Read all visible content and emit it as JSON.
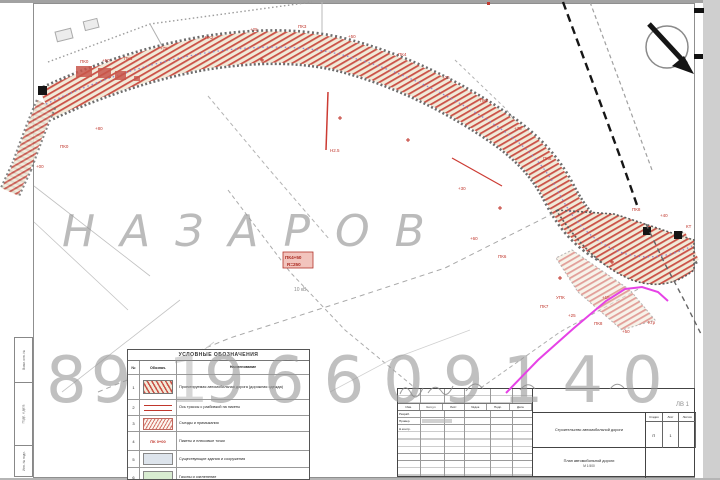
{
  "watermark": {
    "name": "НАЗАРОВ",
    "phone_part1": "89",
    "phone_part2": "1",
    "phone_part3": "96609140"
  },
  "map": {
    "power_note": "10 кВ",
    "station_box": {
      "line1": "ПК4+50",
      "line2": "R=250"
    },
    "pickets": [
      {
        "x": 80,
        "y": 63,
        "t": "ПК0"
      },
      {
        "x": 102,
        "y": 62,
        "t": "+50"
      },
      {
        "x": 124,
        "y": 60,
        "t": "ПК1"
      },
      {
        "x": 160,
        "y": 50,
        "t": "+75"
      },
      {
        "x": 205,
        "y": 39,
        "t": "ПК2"
      },
      {
        "x": 250,
        "y": 31,
        "t": "+25"
      },
      {
        "x": 298,
        "y": 28,
        "t": "ПК3"
      },
      {
        "x": 348,
        "y": 38,
        "t": "+50"
      },
      {
        "x": 398,
        "y": 56,
        "t": "ПК4"
      },
      {
        "x": 442,
        "y": 79,
        "t": "+25"
      },
      {
        "x": 480,
        "y": 102,
        "t": "ПК5"
      },
      {
        "x": 514,
        "y": 130,
        "t": "+75"
      },
      {
        "x": 543,
        "y": 160,
        "t": "ПК6"
      },
      {
        "x": 95,
        "y": 130,
        "t": "+80"
      },
      {
        "x": 60,
        "y": 148,
        "t": "ПК0"
      },
      {
        "x": 36,
        "y": 168,
        "t": "+00"
      },
      {
        "x": 330,
        "y": 152,
        "t": "Н2.5"
      },
      {
        "x": 458,
        "y": 190,
        "t": "+30"
      },
      {
        "x": 470,
        "y": 240,
        "t": "+60"
      },
      {
        "x": 498,
        "y": 258,
        "t": "ПК6"
      },
      {
        "x": 540,
        "y": 308,
        "t": "ПК7"
      },
      {
        "x": 568,
        "y": 317,
        "t": "+25"
      },
      {
        "x": 594,
        "y": 325,
        "t": "ПК8"
      },
      {
        "x": 622,
        "y": 333,
        "t": "+50"
      },
      {
        "x": 648,
        "y": 324,
        "t": "Ктр"
      },
      {
        "x": 602,
        "y": 299,
        "t": "+15"
      },
      {
        "x": 556,
        "y": 299,
        "t": "УПК"
      },
      {
        "x": 632,
        "y": 211,
        "t": "ПК8"
      },
      {
        "x": 660,
        "y": 217,
        "t": "+40"
      },
      {
        "x": 686,
        "y": 228,
        "t": "КТ"
      }
    ],
    "crosses": [
      {
        "x": 340,
        "y": 118
      },
      {
        "x": 408,
        "y": 140
      },
      {
        "x": 262,
        "y": 60
      },
      {
        "x": 500,
        "y": 208
      },
      {
        "x": 560,
        "y": 278
      },
      {
        "x": 612,
        "y": 262
      }
    ]
  },
  "legend": {
    "title": "УСЛОВНЫЕ ОБОЗНАЧЕНИЯ",
    "col_num": "№",
    "col_sym": "Обознач.",
    "col_name": "Наименование",
    "rows": [
      {
        "num": "1",
        "sym": "",
        "name": "Проектируемая автомобильная дорога (дорожная одежда)"
      },
      {
        "num": "2",
        "sym": "",
        "name": "Ось трассы с разбивкой на пикеты"
      },
      {
        "num": "3",
        "sym": "",
        "name": "Съезды и примыкания"
      },
      {
        "num": "4",
        "sym": "ПК 0+00",
        "name": "Пикеты и плюсовые точки"
      },
      {
        "num": "5",
        "sym": "",
        "name": "Существующие здания и сооружения"
      },
      {
        "num": "6",
        "sym": "",
        "name": "Газоны и озеленение"
      }
    ]
  },
  "titleblock": {
    "header_cells": [
      "Изм.",
      "Кол.уч",
      "Лист",
      "№док.",
      "Подп.",
      "Дата"
    ],
    "row_labels": [
      "Разраб.",
      "Провер.",
      "Н.контр."
    ],
    "doc_name": "Строительство автомобильной дороги",
    "drawing_name": "План автомобильной дороги",
    "scale": "М 1:500",
    "stage_label": "Стадия",
    "sheet_label": "Лист",
    "sheets_label": "Листов",
    "stage": "П",
    "sheet": "1",
    "sheets": "",
    "code": "ЛВ 1"
  },
  "sidestamp": {
    "cells": [
      "Взам. инв. №",
      "Подп. и дата",
      "Инв. № подл."
    ]
  }
}
